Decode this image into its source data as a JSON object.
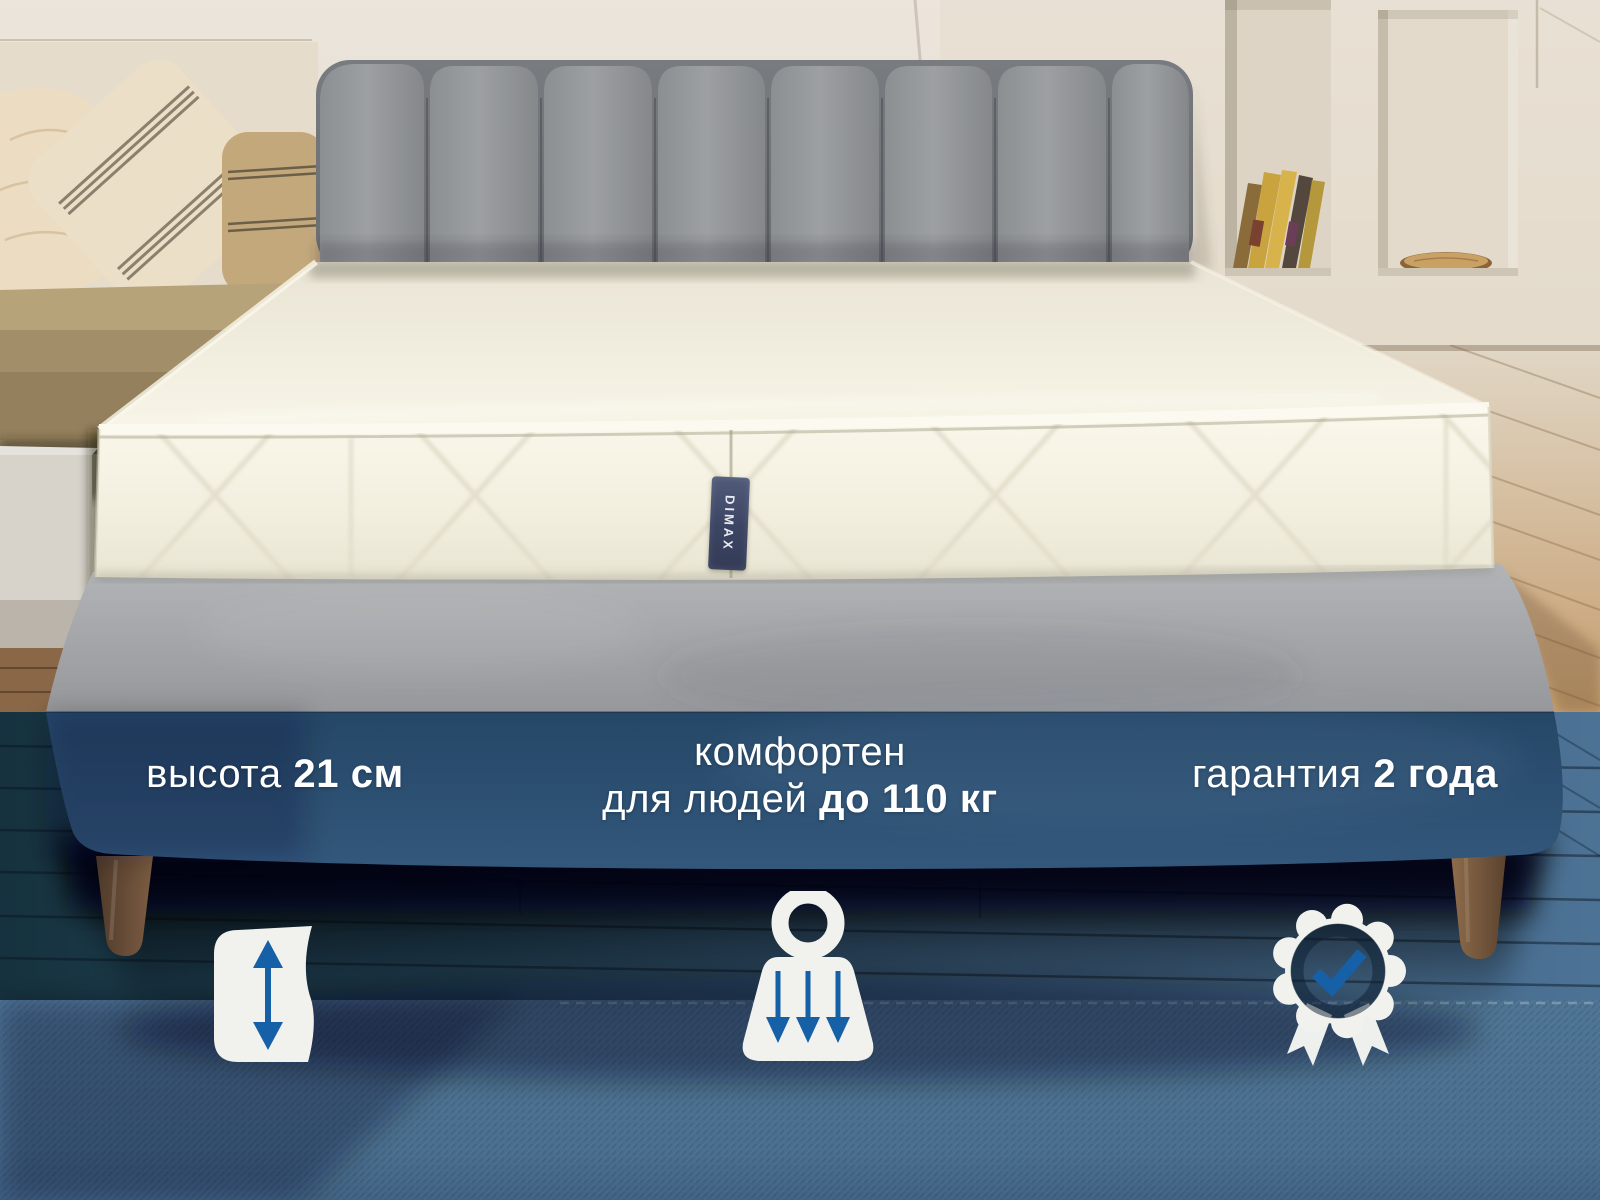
{
  "brand": {
    "tag_text": "DIMAX"
  },
  "stats": {
    "height": {
      "label": "высота",
      "value": "21 см"
    },
    "comfort": {
      "line1": "комфортен",
      "line2_label": "для людей",
      "line2_value": "до 110 кг"
    },
    "warranty": {
      "label": "гарантия",
      "value": "2 года"
    }
  },
  "icons": [
    {
      "name": "mattress-height-icon"
    },
    {
      "name": "weight-capacity-icon"
    },
    {
      "name": "warranty-badge-icon"
    }
  ],
  "colors": {
    "accent_blue": "#1560a6",
    "overlay_navy": "#26496b",
    "icon_white": "#f1f2ee",
    "rug_blue": "#4a7090",
    "headboard_gray": "#94979a",
    "mattress_cream": "#f5f1e2"
  }
}
